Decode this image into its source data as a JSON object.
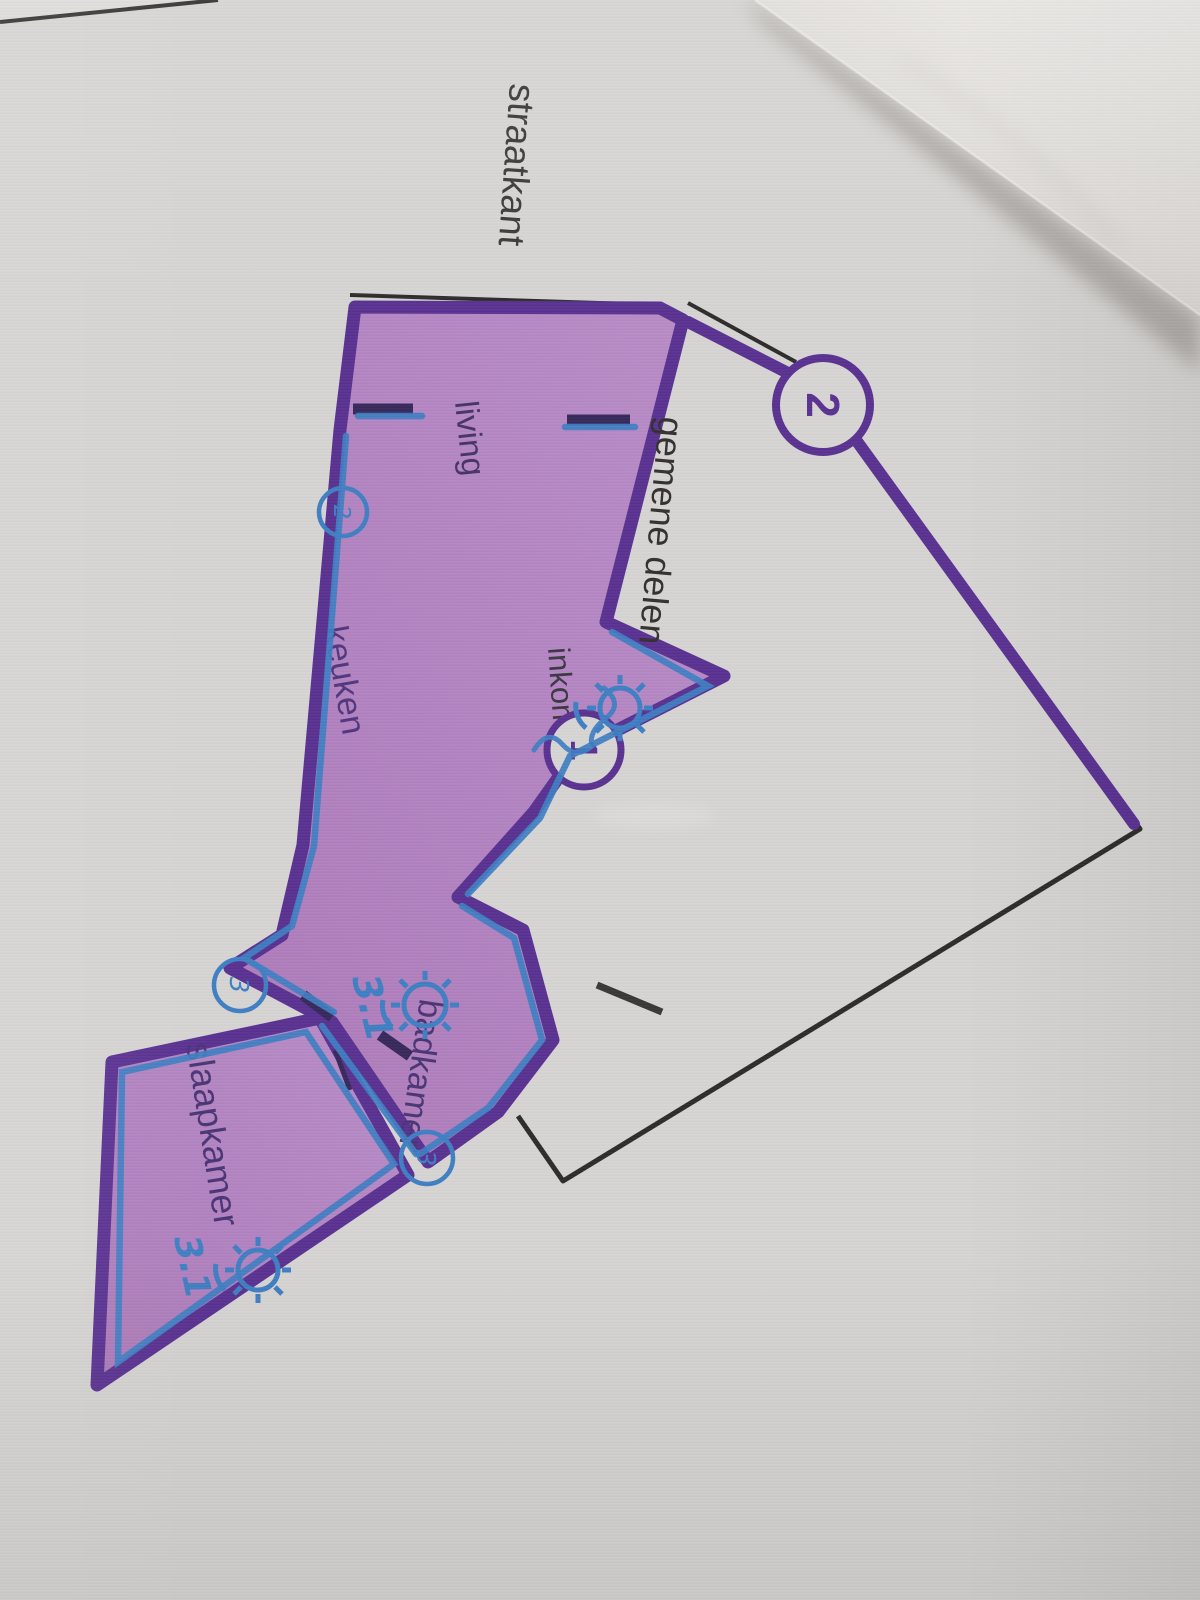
{
  "scene": "photo of a printed floor plan on paper, page rotated 90 degrees with a folded corner",
  "labels": {
    "straatkant": "straatkant",
    "gemene_delen": "gemene delen",
    "living": "living",
    "keuken": "keuken",
    "inkom": "inkom",
    "slaapkamer": "slaapkamer",
    "badkamer": "badkamer"
  },
  "printed_markers": {
    "m1": "1",
    "m2": "2"
  },
  "pen_annotations": {
    "circled_digits": {
      "b1": "2",
      "b2": "3",
      "b3": "3"
    },
    "notes": {
      "n1": "3.1",
      "n2": "3.1"
    },
    "camera_icons": 3
  },
  "colors": {
    "paper": "#d8d6d4",
    "room_fill": "#b384c2",
    "outline_purple": "#5a3292",
    "pen_blue": "#3f7fc3",
    "wall_dark": "#37295a",
    "print_black": "#2e2c2a",
    "room_label": "#4a3575",
    "black_label": "#3a3834"
  }
}
